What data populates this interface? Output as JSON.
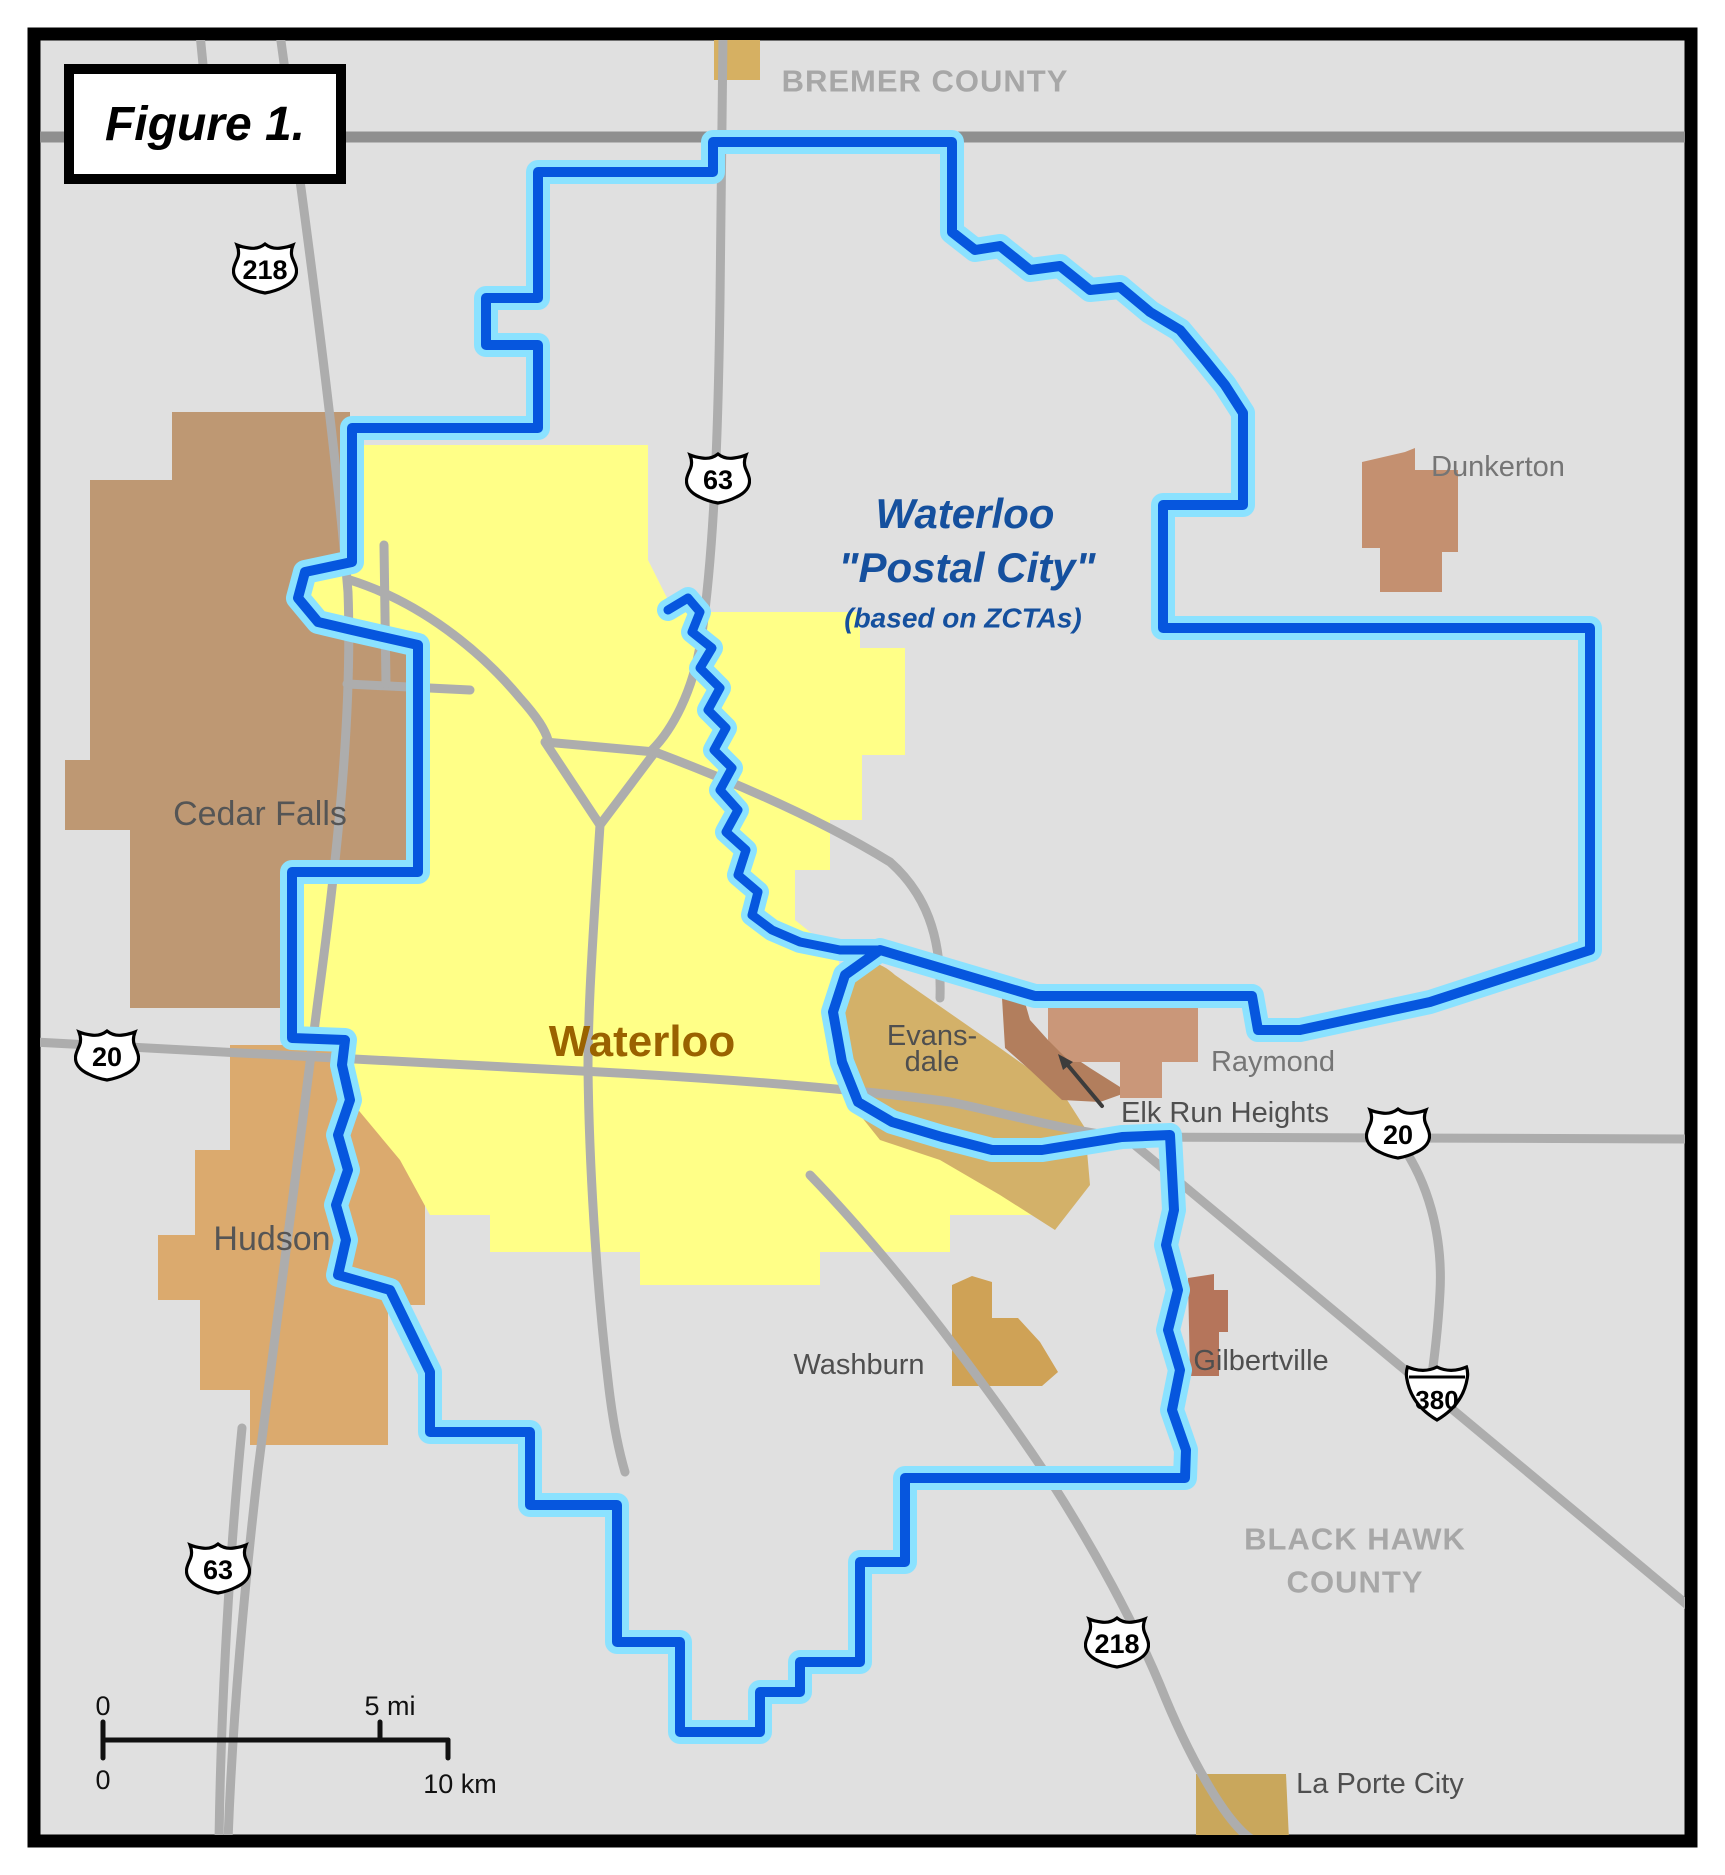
{
  "figure": {
    "label": "Figure 1."
  },
  "map": {
    "counties": {
      "bremer": "BREMER COUNTY",
      "black_hawk_line1": "BLACK HAWK",
      "black_hawk_line2": "COUNTY"
    },
    "postal_city": {
      "line1": "Waterloo",
      "line2": "\"Postal City\"",
      "line3": "(based on ZCTAs)"
    },
    "city_labels": {
      "cedar_falls": "Cedar Falls",
      "waterloo": "Waterloo",
      "evansdale_line1": "Evans-",
      "evansdale_line2": "dale",
      "raymond": "Raymond",
      "elk_run_heights": "Elk Run Heights",
      "hudson": "Hudson",
      "washburn": "Washburn",
      "gilbertville": "Gilbertville",
      "dunkerton": "Dunkerton",
      "la_porte_city": "La Porte City"
    },
    "shields": [
      {
        "system": "US Route",
        "number": "218"
      },
      {
        "system": "US Route",
        "number": "63"
      },
      {
        "system": "US Route",
        "number": "20"
      },
      {
        "system": "US Route",
        "number": "20"
      },
      {
        "system": "Interstate",
        "number": "380"
      },
      {
        "system": "US Route",
        "number": "63"
      },
      {
        "system": "US Route",
        "number": "218"
      }
    ],
    "scale": {
      "mi_zero": "0",
      "mi_max": "5 mi",
      "km_zero": "0",
      "km_max": "10 km"
    },
    "colors": {
      "background": "#E0E0E0",
      "boundary_blue": "#0656DE",
      "boundary_halo": "#8BE2FF",
      "waterloo_fill": "#FFFF87",
      "cedar_falls_fill": "#BE9873",
      "hudson_fill": "#DBAA6E",
      "evansdale_fill": "#D3B169",
      "elk_run_heights_fill": "#B27E5D",
      "raymond_fill": "#CA9779",
      "dunkerton_fill": "#C49070",
      "washburn_fill": "#CFA256",
      "gilbertville_fill": "#B5755B",
      "la_porte_city_fill": "#C9A75C",
      "north_parcel_fill": "#D6B062",
      "road": "#ADADAD",
      "county_line": "#8F8F8F",
      "frame": "#000000"
    }
  }
}
